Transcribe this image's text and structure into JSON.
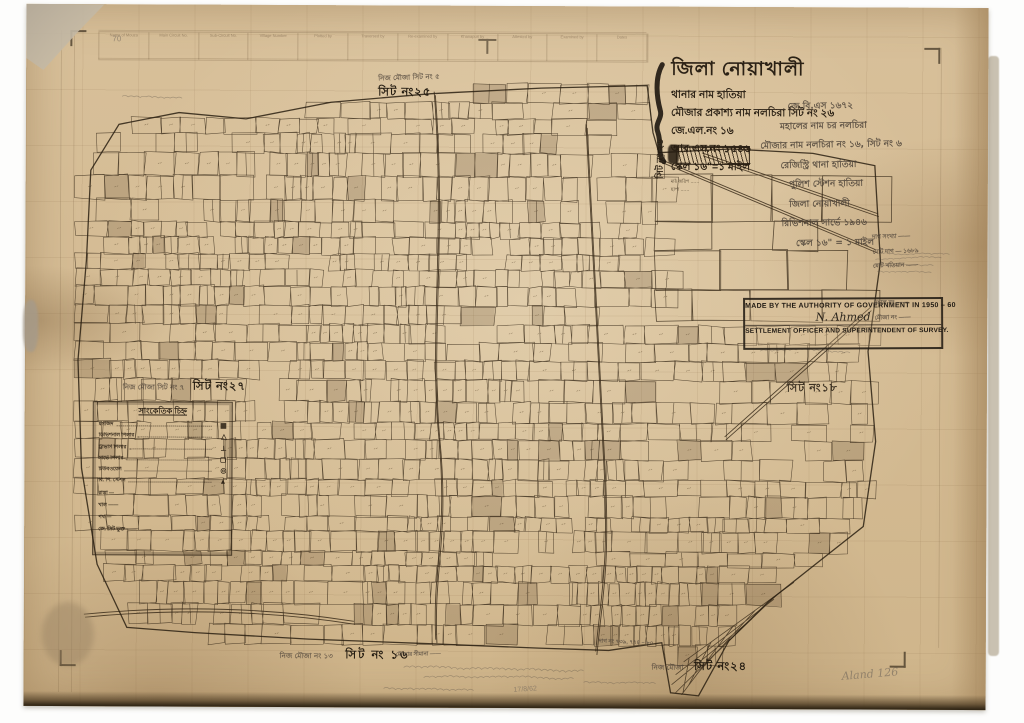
{
  "colors": {
    "paper": "#d6bd96",
    "map_ink": "#3a2c1a",
    "stamp_ink": "#201a13",
    "handwriting_ink": "#4c4238",
    "pencil": "#6f655a"
  },
  "title_block": {
    "district": "জিলা নোয়াখালী",
    "thana": "থানার নাম হাতিয়া",
    "mouza": "মৌজার প্রকাশ্য নাম নলচিরা সিট নং ২৬",
    "jl_no": "জে.এল.নং ১৬",
    "rs_no": "আর.এস.নং ১৫৪৬",
    "scale": "স্কেল ১৬\"=১ মাইল",
    "footnote1": "মাঠ জরিপ ……",
    "footnote2": "ছাপা ……",
    "sheet_no_vertical": "সিট নং ২৬"
  },
  "handwritten_block": {
    "lines": [
      "জে.বি.এস ১৬৭২",
      "মহালের নাম চর নলচিরা",
      "মৌজার নাম নলচিরা নং ১৬, সিট নং ৬",
      "রেজিস্ট্রি থানা হাতিয়া",
      "পুলিশ স্টেশন হাতিয়া",
      "জিলা নোয়াখালী",
      "রিভিশনাল সার্ভে ১৯৪৬",
      "স্কেল ১৬\" = ১ মাইল"
    ]
  },
  "stamp": {
    "authority": "MADE BY THE AUTHORITY OF GOVERNMENT IN 1950 – 60",
    "signature": "N. Ahmed",
    "officer": "SETTLEMENT OFFICER AND SUPERINTENDENT OF SURVEY."
  },
  "side_notes": {
    "lines": [
      "দাগ সংখ্যা ——",
      "মোট দাগ — ১৬৮৯",
      "মোট খতিয়ান ——",
      "মহাল নং ——",
      "মৌজা নং ——"
    ]
  },
  "sheet_labels": {
    "top": {
      "note": "নিজ মৌজা সিট নং ৫",
      "stamp": "সিট নং২৫"
    },
    "left": {
      "note": "নিজ মৌজা সিট নং ৭",
      "stamp": "সিট নং২৭"
    },
    "right": {
      "stamp": "সিট নং১৮"
    },
    "bottom_left": {
      "note": "নিজ মৌজা নং ১৩",
      "stamp": "সিট নং ১৬"
    },
    "bottom_right": {
      "note": "নিজ মৌজা",
      "stamp": "সিট নং২৪"
    }
  },
  "legend": {
    "title": "সাংকেতিক চিহ্ন",
    "items": [
      {
        "label": "মসজিদ",
        "symbol": "▦"
      },
      {
        "label": "ডিভিশনাল পিলার",
        "symbol": "△"
      },
      {
        "label": "ট্রাভার্স পিলার",
        "symbol": "⊥"
      },
      {
        "label": "সার্ভে পিলার",
        "symbol": "▢"
      },
      {
        "label": "টিউবওয়েল",
        "symbol": "◎"
      },
      {
        "label": "বি. পি. স্টেশন",
        "symbol": "▲"
      }
    ],
    "extras": [
      "রাস্তা —",
      "খাল ——",
      "পথ —",
      "জে. সিট ভুক্ত ——"
    ]
  },
  "survey_strip": {
    "columns": [
      "Name of Mouza",
      "Main Circuit No.",
      "Sub-Circuit No.",
      "Village Number",
      "Plotted by",
      "Traversed by",
      "Re-examined by",
      "Khanapuri by",
      "Attested by",
      "Examined by",
      "Dates"
    ]
  },
  "margin_notes": {
    "top_left_pencil": "70",
    "boundary_note": "মৌজার সীমানা ——",
    "plot_note": "দাগ নং ৭৩৯, ৭৭৪ – ৮০",
    "date": "17/8/62",
    "signature": "Aland 126"
  }
}
